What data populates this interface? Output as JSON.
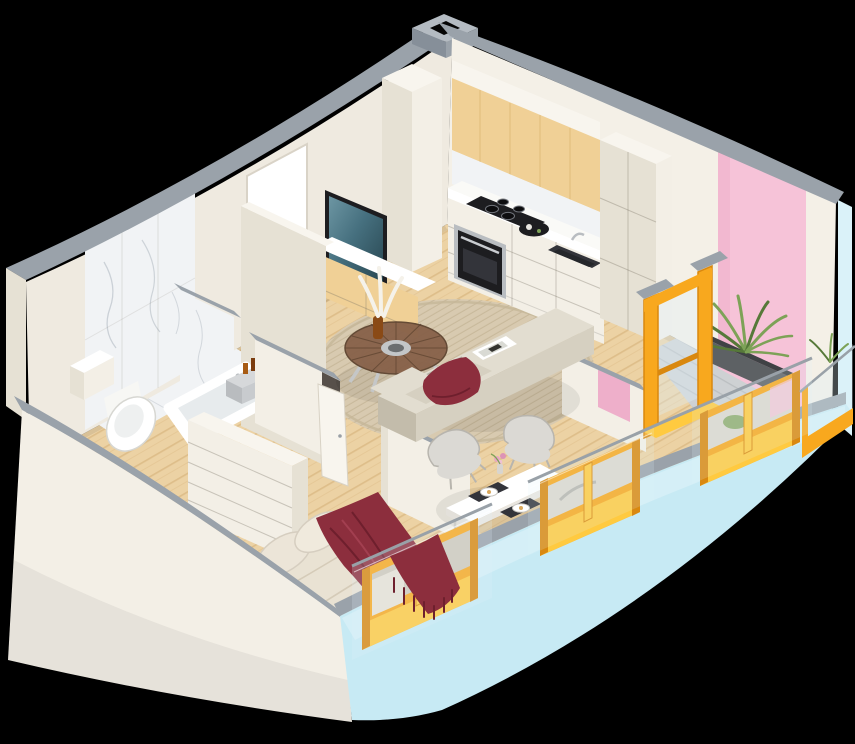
{
  "scene": {
    "description": "Isometric 3D cutaway render of a one-bedroom apartment floor plan with cream interior walls, light-blue exterior walls, yellow window reveals and a pink accent wall by the balcony",
    "rooms": [
      {
        "name": "kitchen",
        "items": [
          "wood upper cabinet panel",
          "white lower cabinets",
          "induction cooktop",
          "built-in oven",
          "sink with faucet",
          "serving tray",
          "tall cabinet",
          "white column",
          "service duct"
        ]
      },
      {
        "name": "living-room",
        "items": [
          "round wood-glass coffee table",
          "amber vase with pampas",
          "round jute rug",
          "beige L-shaped sofa",
          "burgundy pillow",
          "magazine",
          "wall TV",
          "wood media cabinet"
        ]
      },
      {
        "name": "dining-nook",
        "items": [
          "white dining table",
          "three molded chairs",
          "dark placemats",
          "plates",
          "flower vase"
        ]
      },
      {
        "name": "bedroom",
        "items": [
          "double bed",
          "beige duvet",
          "two pillows",
          "burgundy throw with fringe",
          "white dresser",
          "open door",
          "yellow framed window"
        ]
      },
      {
        "name": "bathroom",
        "items": [
          "marble tiled wall",
          "marble floor",
          "wall-hung toilet",
          "bathtub",
          "vanity block"
        ]
      },
      {
        "name": "hallway",
        "items": [
          "console table",
          "perfume bottles",
          "towels",
          "entry doorway"
        ]
      },
      {
        "name": "balcony",
        "items": [
          "concrete deck",
          "planter",
          "palm plant",
          "orange sliding door",
          "glass railing",
          "yellow glazing"
        ]
      }
    ]
  },
  "colors": {
    "gray_top": "#9aa2aa",
    "gray_top_dark": "#868f99",
    "gray_top_light": "#b4bbc2",
    "wall_cream": "#f3efe6",
    "wall_cream_shade": "#e6e1d4",
    "wall_cream_dark": "#f8f5ee",
    "wall_interior": "#efeae0",
    "wall_interior2": "#f4f0e7",
    "marble": "#f1f3f5",
    "marble_vein": "#c4cad1",
    "pink": "#f6c3d8",
    "pink_shade": "#eeafca",
    "blue_wall": "#c7eaf4",
    "blue_edge": "#daf2f9",
    "yellow_bright": "#ffca40",
    "yellow_mid": "#f8a81e",
    "orange_deep": "#d9880f",
    "wood_floor": "#ecd2a4",
    "wood_stripe": "#d0a96f",
    "wood_cabinet": "#f0d096",
    "wood_grain": "#ddb876",
    "counter": "#fafaf7",
    "white": "#ffffff",
    "appliance_black": "#1d1d20",
    "appliance_dark": "#33343a",
    "steel": "#b9bdc1",
    "sofa": "#d6d0c1",
    "sofa_light": "#e2ddd0",
    "sofa_dark": "#c3bcab",
    "maroon": "#8c2e3d",
    "maroon_dark": "#6e1f2d",
    "maroon_light": "#a23f50",
    "rug": "#d8cab0",
    "rug_stripe": "#c6b698",
    "table_wood": "#876149",
    "table_wood_dark": "#5e4430",
    "chair": "#dbd9d4",
    "chair_shade": "#b8b5ae",
    "plant": "#7da257",
    "plant_dark": "#567939",
    "concrete": "#ced1d3",
    "concrete_stripe": "#bbbfc1",
    "glass": "#dff2f8",
    "rail": "#99a1a8",
    "interior_hint": "#cfc8bb",
    "interior_hint2": "#dcd7ce"
  }
}
